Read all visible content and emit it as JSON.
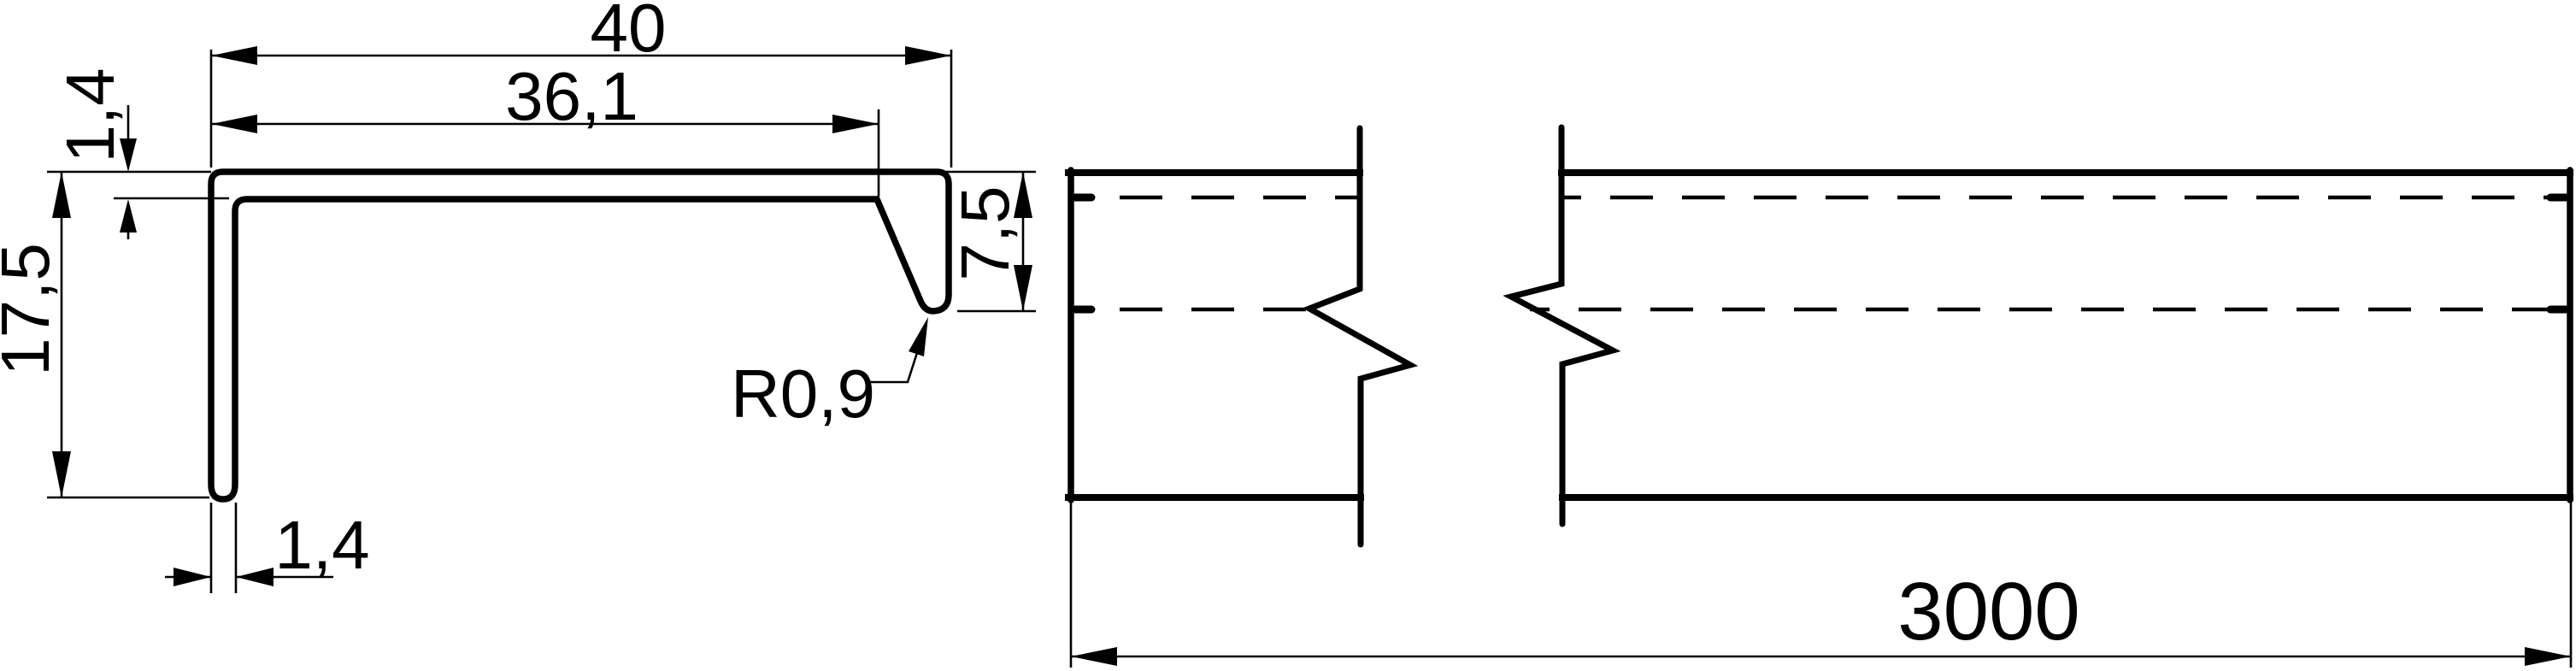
{
  "drawing": {
    "background": "#ffffff",
    "line_color": "#000000",
    "views": {
      "cross_section": {
        "name": "profile-cross-section",
        "dims": {
          "overall_width": "40",
          "inner_width": "36,1",
          "flange_thickness": "1,4",
          "overall_height": "17,5",
          "lip_height": "7,5",
          "corner_radius": "R0,9",
          "leg_thickness": "1,4"
        }
      },
      "side_view": {
        "name": "profile-length-view",
        "dims": {
          "length": "3000"
        }
      }
    }
  }
}
